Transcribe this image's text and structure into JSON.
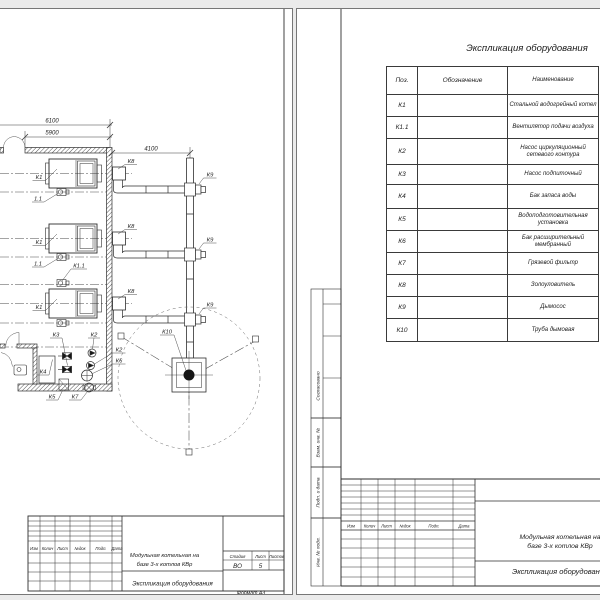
{
  "left_page": {
    "dimensions": {
      "total": "6100",
      "inner": "5900",
      "right": "4100"
    },
    "equipment_labels": {
      "boiler": "К1",
      "fan_short": "1.1",
      "fan": "К1.1",
      "pump_network": "К2",
      "pump_makeup": "К3",
      "tank": "К4",
      "water_treatment": "К5",
      "expansion_tank": "К6",
      "mud_filter": "К7",
      "ash_collector": "К8",
      "smoke_exhauster": "К9",
      "chimney": "К10"
    },
    "title_block": {
      "rev_cols": [
        "Изм",
        "Колич",
        "Лист",
        "№док",
        "Подп.",
        "Дата"
      ],
      "project": "Модульная котельная на\nбазе 3-х котлов КВр",
      "doc": "Экспликация оборудования",
      "stage_label": "Стадия",
      "sheet_label": "Лист",
      "sheets_label": "Листов",
      "stage": "ВО",
      "sheet": "5",
      "sheets": "",
      "format": "Формат  А3"
    }
  },
  "right_page": {
    "title": "Экспликация оборудования",
    "table": {
      "headers": [
        "Поз.",
        "Обозначение",
        "Наименование"
      ],
      "rows": [
        {
          "pos": "К1",
          "name": "Стальной водогрейный котел"
        },
        {
          "pos": "К1.1",
          "name": "Вентилятор подачи воздуха"
        },
        {
          "pos": "К2",
          "name": "Насос циркуляционный\nсетевого контура"
        },
        {
          "pos": "К3",
          "name": "Насос подпиточный"
        },
        {
          "pos": "К4",
          "name": "Бак запаса воды"
        },
        {
          "pos": "К5",
          "name": "Водоподготовительная установка"
        },
        {
          "pos": "К6",
          "name": "Бак расширительный мембранный"
        },
        {
          "pos": "К7",
          "name": "Грязевой фильтр"
        },
        {
          "pos": "К8",
          "name": "Золоуловитель"
        },
        {
          "pos": "К9",
          "name": "Дымосос"
        },
        {
          "pos": "К10",
          "name": "Труба дымовая"
        }
      ]
    },
    "stamps": {
      "agreed": "Согласовано",
      "replace_inv": "Взам. инв. №",
      "sign_date": "Подп. и дата",
      "inv_orig": "Инв. № подл."
    },
    "title_block": {
      "rev_cols": [
        "Изм",
        "Колич",
        "Лист",
        "№док",
        "Подп.",
        "Дата"
      ],
      "project": "Модульная котельная на\nбазе 3-х котлов КВр",
      "doc": "Экспликация оборудования"
    }
  }
}
